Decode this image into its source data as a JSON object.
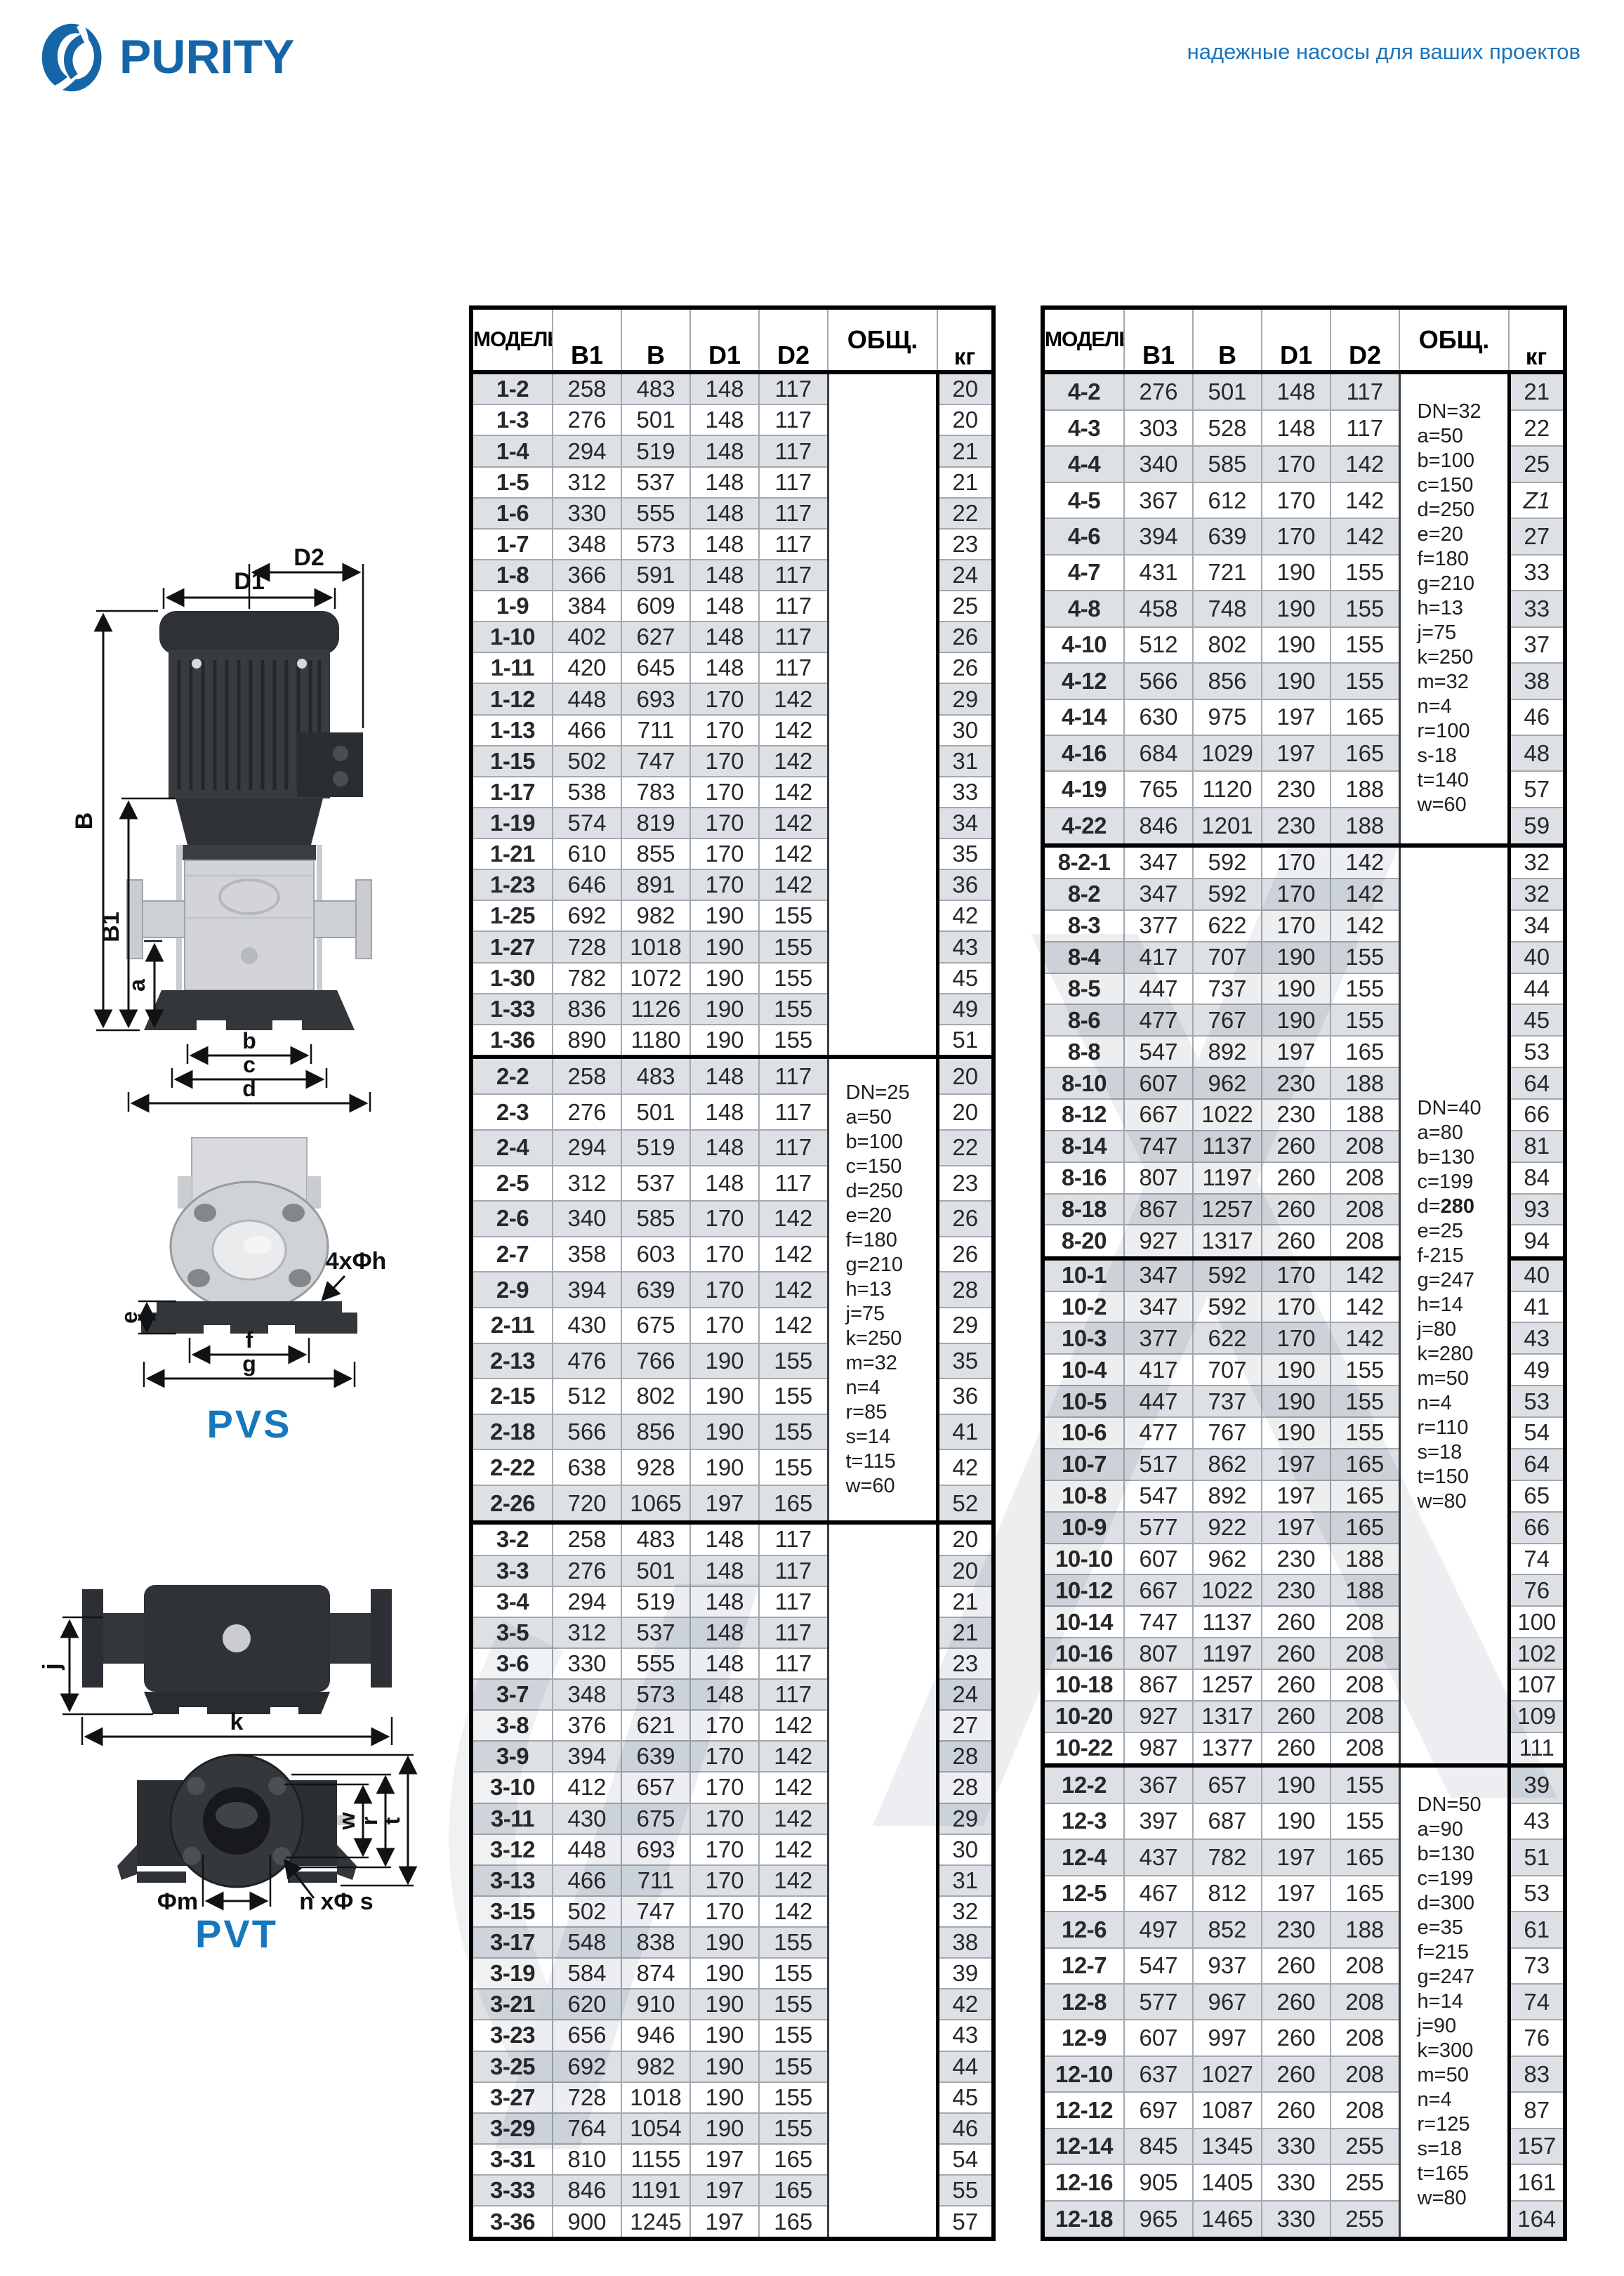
{
  "page": {
    "brand": "PURITY",
    "tagline": "надежные насосы для ваших проектов"
  },
  "diagrams": {
    "pvs": {
      "label": "PVS",
      "dims": {
        "D1": "D1",
        "D2": "D2",
        "B": "B",
        "B1": "B1",
        "a": "a",
        "b": "b",
        "c": "c",
        "d": "d",
        "e": "e",
        "f": "f",
        "g": "g",
        "holes": "4xΦh"
      }
    },
    "pvt": {
      "label": "PVT",
      "dims": {
        "j": "j",
        "k": "k",
        "w": "w",
        "r": "r",
        "t": "t",
        "m": "Φm",
        "holes": "n xΦ s"
      }
    }
  },
  "tables": [
    {
      "name": "models-1-2-3",
      "columns": [
        "МОДЕЛЬ",
        "B1",
        "B",
        "D1",
        "D2",
        "ОБЩ.",
        "кг"
      ],
      "groups": [
        {
          "note": null,
          "rows": [
            [
              "1-2",
              258,
              483,
              148,
              117,
              20
            ],
            [
              "1-3",
              276,
              501,
              148,
              117,
              20
            ],
            [
              "1-4",
              294,
              519,
              148,
              117,
              21
            ],
            [
              "1-5",
              312,
              537,
              148,
              117,
              21
            ],
            [
              "1-6",
              330,
              555,
              148,
              117,
              22
            ],
            [
              "1-7",
              348,
              573,
              148,
              117,
              23
            ],
            [
              "1-8",
              366,
              591,
              148,
              117,
              24
            ],
            [
              "1-9",
              384,
              609,
              148,
              117,
              25
            ],
            [
              "1-10",
              402,
              627,
              148,
              117,
              26
            ],
            [
              "1-11",
              420,
              645,
              148,
              117,
              26
            ],
            [
              "1-12",
              448,
              693,
              170,
              142,
              29
            ],
            [
              "1-13",
              466,
              711,
              170,
              142,
              30
            ],
            [
              "1-15",
              502,
              747,
              170,
              142,
              31
            ],
            [
              "1-17",
              538,
              783,
              170,
              142,
              33
            ],
            [
              "1-19",
              574,
              819,
              170,
              142,
              34
            ],
            [
              "1-21",
              610,
              855,
              170,
              142,
              35
            ],
            [
              "1-23",
              646,
              891,
              170,
              142,
              36
            ],
            [
              "1-25",
              692,
              982,
              190,
              155,
              42
            ],
            [
              "1-27",
              728,
              1018,
              190,
              155,
              43
            ],
            [
              "1-30",
              782,
              1072,
              190,
              155,
              45
            ],
            [
              "1-33",
              836,
              1126,
              190,
              155,
              49
            ],
            [
              "1-36",
              890,
              1180,
              190,
              155,
              51
            ]
          ]
        },
        {
          "note": {
            "lines": [
              "DN=25",
              "a=50",
              "b=100",
              "c=150",
              "d=250",
              "e=20",
              "f=180",
              "g=210",
              "h=13",
              "j=75",
              "k=250",
              "m=32",
              "n=4",
              "r=85",
              "s=14",
              "t=115",
              "w=60"
            ],
            "bold": []
          },
          "rows": [
            [
              "2-2",
              258,
              483,
              148,
              117,
              20
            ],
            [
              "2-3",
              276,
              501,
              148,
              117,
              20
            ],
            [
              "2-4",
              294,
              519,
              148,
              117,
              22
            ],
            [
              "2-5",
              312,
              537,
              148,
              117,
              23
            ],
            [
              "2-6",
              340,
              585,
              170,
              142,
              26
            ],
            [
              "2-7",
              358,
              603,
              170,
              142,
              26
            ],
            [
              "2-9",
              394,
              639,
              170,
              142,
              28
            ],
            [
              "2-11",
              430,
              675,
              170,
              142,
              29
            ],
            [
              "2-13",
              476,
              766,
              190,
              155,
              35
            ],
            [
              "2-15",
              512,
              802,
              190,
              155,
              36
            ],
            [
              "2-18",
              566,
              856,
              190,
              155,
              41
            ],
            [
              "2-22",
              638,
              928,
              190,
              155,
              42
            ],
            [
              "2-26",
              720,
              1065,
              197,
              165,
              52
            ]
          ]
        },
        {
          "note": null,
          "rows": [
            [
              "3-2",
              258,
              483,
              148,
              117,
              20
            ],
            [
              "3-3",
              276,
              501,
              148,
              117,
              20
            ],
            [
              "3-4",
              294,
              519,
              148,
              117,
              21
            ],
            [
              "3-5",
              312,
              537,
              148,
              117,
              21
            ],
            [
              "3-6",
              330,
              555,
              148,
              117,
              23
            ],
            [
              "3-7",
              348,
              573,
              148,
              117,
              24
            ],
            [
              "3-8",
              376,
              621,
              170,
              142,
              27
            ],
            [
              "3-9",
              394,
              639,
              170,
              142,
              28
            ],
            [
              "3-10",
              412,
              657,
              170,
              142,
              28
            ],
            [
              "3-11",
              430,
              675,
              170,
              142,
              29
            ],
            [
              "3-12",
              448,
              693,
              170,
              142,
              30
            ],
            [
              "3-13",
              466,
              711,
              170,
              142,
              31
            ],
            [
              "3-15",
              502,
              747,
              170,
              142,
              32
            ],
            [
              "3-17",
              548,
              838,
              190,
              155,
              38
            ],
            [
              "3-19",
              584,
              874,
              190,
              155,
              39
            ],
            [
              "3-21",
              620,
              910,
              190,
              155,
              42
            ],
            [
              "3-23",
              656,
              946,
              190,
              155,
              43
            ],
            [
              "3-25",
              692,
              982,
              190,
              155,
              44
            ],
            [
              "3-27",
              728,
              1018,
              190,
              155,
              45
            ],
            [
              "3-29",
              764,
              1054,
              190,
              155,
              46
            ],
            [
              "3-31",
              810,
              1155,
              197,
              165,
              54
            ],
            [
              "3-33",
              846,
              1191,
              197,
              165,
              55
            ],
            [
              "3-36",
              900,
              1245,
              197,
              165,
              57
            ]
          ]
        }
      ]
    },
    {
      "name": "models-4-8-10-12",
      "columns": [
        "МОДЕЛЬ",
        "B1",
        "B",
        "D1",
        "D2",
        "ОБЩ.",
        "кг"
      ],
      "groups": [
        {
          "note": {
            "lines": [
              "DN=32",
              "a=50",
              "b=100",
              "c=150",
              "d=250",
              "e=20",
              "f=180",
              "g=210",
              "h=13",
              "j=75",
              "k=250",
              "m=32",
              "n=4",
              "r=100",
              "s-18",
              "t=140",
              "w=60"
            ],
            "bold": []
          },
          "rows": [
            [
              "4-2",
              276,
              501,
              148,
              117,
              21
            ],
            [
              "4-3",
              303,
              528,
              148,
              117,
              22
            ],
            [
              "4-4",
              340,
              585,
              170,
              142,
              25
            ],
            [
              "4-5",
              367,
              612,
              170,
              142,
              "Z1"
            ],
            [
              "4-6",
              394,
              639,
              170,
              142,
              27
            ],
            [
              "4-7",
              431,
              721,
              190,
              155,
              33
            ],
            [
              "4-8",
              458,
              748,
              190,
              155,
              33
            ],
            [
              "4-10",
              512,
              802,
              190,
              155,
              37
            ],
            [
              "4-12",
              566,
              856,
              190,
              155,
              38
            ],
            [
              "4-14",
              630,
              975,
              197,
              165,
              46
            ],
            [
              "4-16",
              684,
              1029,
              197,
              165,
              48
            ],
            [
              "4-19",
              765,
              1120,
              230,
              188,
              57
            ],
            [
              "4-22",
              846,
              1201,
              230,
              188,
              59
            ]
          ]
        },
        {
          "note": {
            "lines": [
              "DN=40",
              "a=80",
              "b=130",
              "c=199",
              "d=280",
              "e=25",
              "f-215",
              "g=247",
              "h=14",
              "j=80",
              "k=280",
              "m=50",
              "n=4",
              "r=110",
              "s=18",
              "t=150",
              "w=80"
            ],
            "bold": [
              "d=280"
            ]
          },
          "thick_after": [
            "8-20"
          ],
          "rows": [
            [
              "8-2-1",
              347,
              592,
              170,
              142,
              32
            ],
            [
              "8-2",
              347,
              592,
              170,
              142,
              32
            ],
            [
              "8-3",
              377,
              622,
              170,
              142,
              34
            ],
            [
              "8-4",
              417,
              707,
              190,
              155,
              40
            ],
            [
              "8-5",
              447,
              737,
              190,
              155,
              44
            ],
            [
              "8-6",
              477,
              767,
              190,
              155,
              45
            ],
            [
              "8-8",
              547,
              892,
              197,
              165,
              53
            ],
            [
              "8-10",
              607,
              962,
              230,
              188,
              64
            ],
            [
              "8-12",
              667,
              1022,
              230,
              188,
              66
            ],
            [
              "8-14",
              747,
              1137,
              260,
              208,
              81
            ],
            [
              "8-16",
              807,
              1197,
              260,
              208,
              84
            ],
            [
              "8-18",
              867,
              1257,
              260,
              208,
              93
            ],
            [
              "8-20",
              927,
              1317,
              260,
              208,
              94
            ],
            [
              "10-1",
              347,
              592,
              170,
              142,
              40
            ],
            [
              "10-2",
              347,
              592,
              170,
              142,
              41
            ],
            [
              "10-3",
              377,
              622,
              170,
              142,
              43
            ],
            [
              "10-4",
              417,
              707,
              190,
              155,
              49
            ],
            [
              "10-5",
              447,
              737,
              190,
              155,
              53
            ],
            [
              "10-6",
              477,
              767,
              190,
              155,
              54
            ],
            [
              "10-7",
              517,
              862,
              197,
              165,
              64
            ],
            [
              "10-8",
              547,
              892,
              197,
              165,
              65
            ],
            [
              "10-9",
              577,
              922,
              197,
              165,
              66
            ],
            [
              "10-10",
              607,
              962,
              230,
              188,
              74
            ],
            [
              "10-12",
              667,
              1022,
              230,
              188,
              76
            ],
            [
              "10-14",
              747,
              1137,
              260,
              208,
              100
            ],
            [
              "10-16",
              807,
              1197,
              260,
              208,
              102
            ],
            [
              "10-18",
              867,
              1257,
              260,
              208,
              107
            ],
            [
              "10-20",
              927,
              1317,
              260,
              208,
              109
            ],
            [
              "10-22",
              987,
              1377,
              260,
              208,
              111
            ]
          ]
        },
        {
          "note": {
            "lines": [
              "DN=50",
              "a=90",
              "b=130",
              "c=199",
              "d=300",
              "e=35",
              "f=215",
              "g=247",
              "h=14",
              "j=90",
              "k=300",
              "m=50",
              "n=4",
              "r=125",
              "s=18",
              "t=165",
              "w=80"
            ],
            "bold": []
          },
          "rows": [
            [
              "12-2",
              367,
              657,
              190,
              155,
              39
            ],
            [
              "12-3",
              397,
              687,
              190,
              155,
              43
            ],
            [
              "12-4",
              437,
              782,
              197,
              165,
              51
            ],
            [
              "12-5",
              467,
              812,
              197,
              165,
              53
            ],
            [
              "12-6",
              497,
              852,
              230,
              188,
              61
            ],
            [
              "12-7",
              547,
              937,
              260,
              208,
              73
            ],
            [
              "12-8",
              577,
              967,
              260,
              208,
              74
            ],
            [
              "12-9",
              607,
              997,
              260,
              208,
              76
            ],
            [
              "12-10",
              637,
              1027,
              260,
              208,
              83
            ],
            [
              "12-12",
              697,
              1087,
              260,
              208,
              87
            ],
            [
              "12-14",
              845,
              1345,
              330,
              255,
              157
            ],
            [
              "12-16",
              905,
              1405,
              330,
              255,
              161
            ],
            [
              "12-18",
              965,
              1465,
              330,
              255,
              164
            ]
          ]
        }
      ]
    }
  ]
}
